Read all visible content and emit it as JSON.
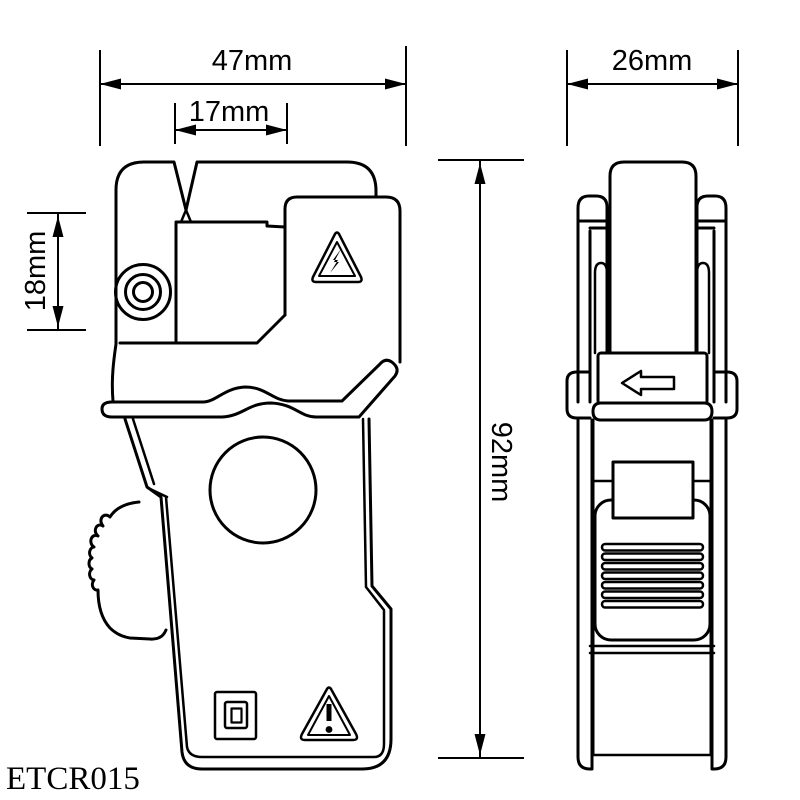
{
  "model_label": "ETCR015",
  "dimensions": {
    "front_width": "47mm",
    "jaw_window_width": "17mm",
    "hinge_height": "18mm",
    "overall_height": "92mm",
    "side_width": "26mm"
  },
  "symbols": {
    "jaw_warning": "high-voltage-warning-triangle",
    "body_warning": "caution-warning-triangle",
    "insulation": "double-insulation-squares",
    "side_arrow": "arrow-left"
  },
  "colors": {
    "line": "#000000",
    "background": "#ffffff"
  }
}
